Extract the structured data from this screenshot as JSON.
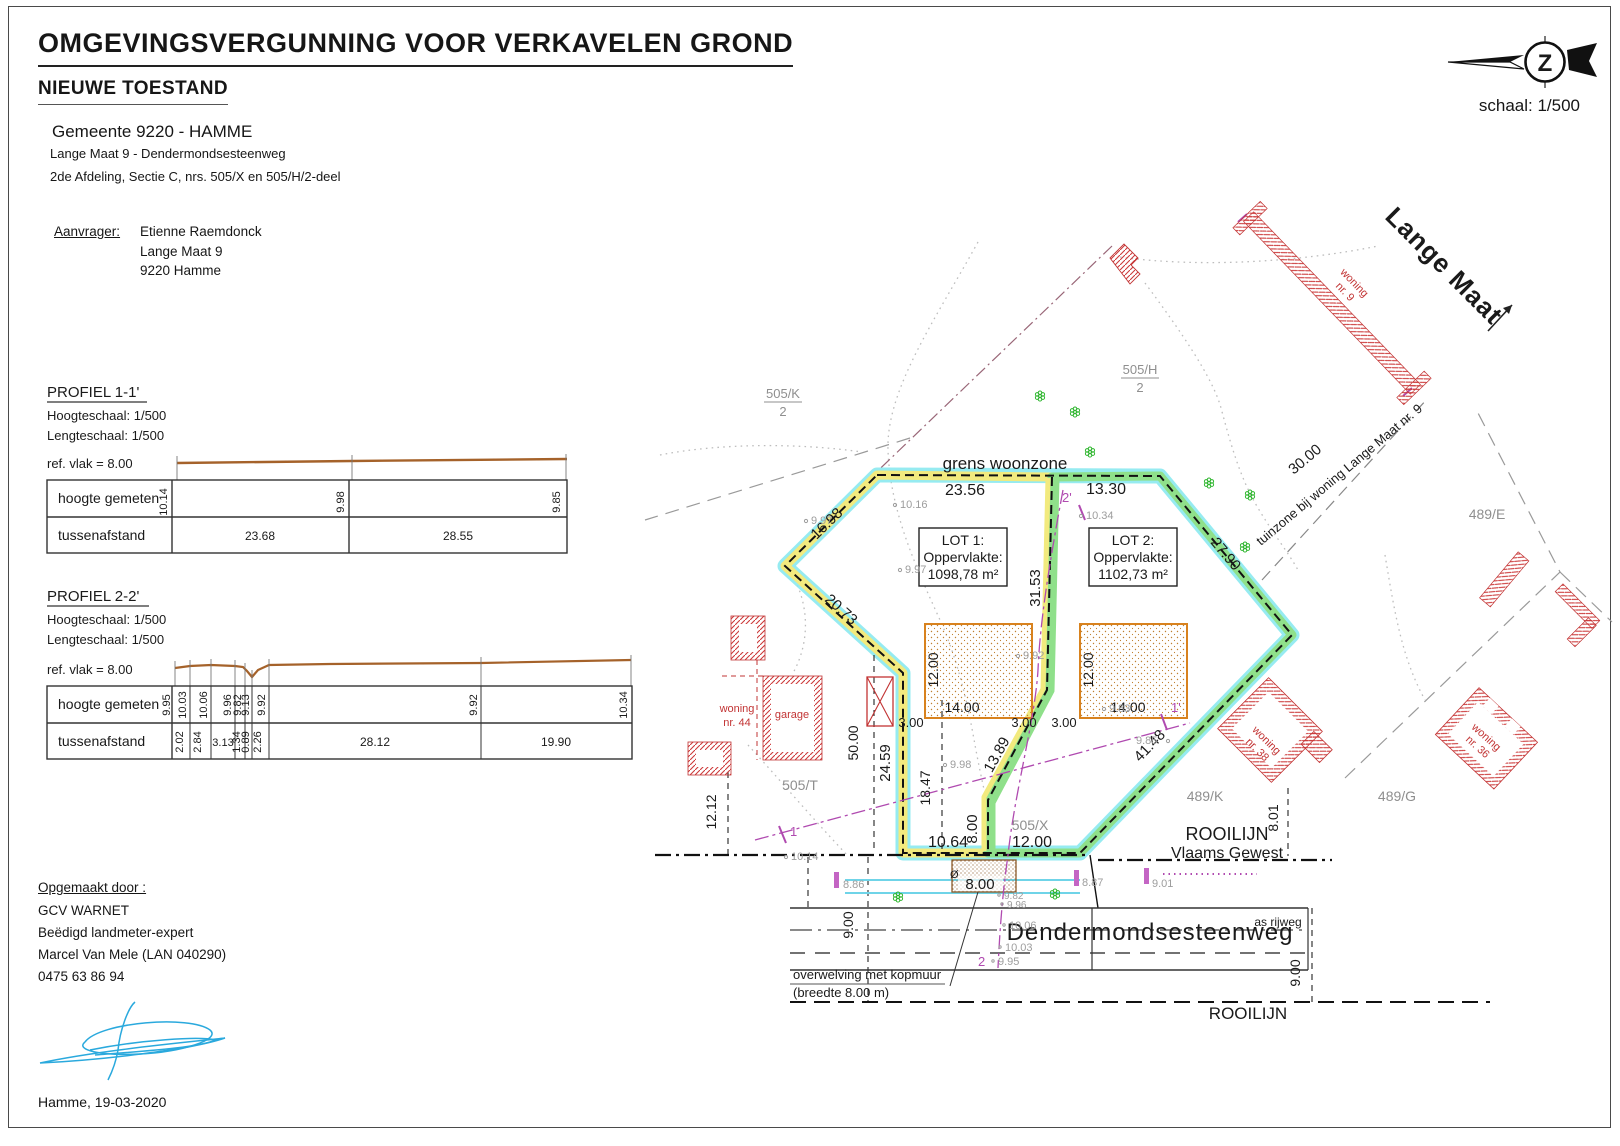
{
  "page": {
    "title": "OMGEVINGSVERGUNNING VOOR VERKAVELEN GROND",
    "subtitle": "NIEUWE TOESTAND",
    "municipality": "Gemeente 9220 - HAMME",
    "address_line1": "Lange Maat 9 - Dendermondsesteenweg",
    "address_line2": "2de Afdeling, Sectie C, nrs. 505/X en 505/H/2-deel",
    "scale_label": "schaal: 1/500",
    "north_letter": "Z",
    "date_line": "Hamme, 19-03-2020"
  },
  "applicant": {
    "label": "Aanvrager:",
    "name": "Etienne Raemdonck",
    "street": "Lange Maat 9",
    "city": "9220 Hamme"
  },
  "author": {
    "label": "Opgemaakt door :",
    "company": "GCV WARNET",
    "role": "Beëdigd landmeter-expert",
    "name": "Marcel Van Mele (LAN 040290)",
    "phone": "0475 63 86 94"
  },
  "profile1": {
    "title": "PROFIEL 1-1'",
    "height_scale": "Hoogteschaal: 1/500",
    "length_scale": "Lengteschaal: 1/500",
    "ref_plane": "ref. vlak = 8.00",
    "row_heights": "hoogte gemeten",
    "row_distances": "tussenafstand",
    "heights": [
      "10.14",
      "9.98",
      "9.85"
    ],
    "distances": [
      "23.68",
      "28.55"
    ]
  },
  "profile2": {
    "title": "PROFIEL 2-2'",
    "height_scale": "Hoogteschaal: 1/500",
    "length_scale": "Lengteschaal: 1/500",
    "ref_plane": "ref. vlak = 8.00",
    "row_heights": "hoogte gemeten",
    "row_distances": "tussenafstand",
    "heights": [
      "9.95",
      "10.03",
      "10.06",
      "9.96",
      "9.82",
      "9.13",
      "9.92",
      "9.92",
      "10.34"
    ],
    "distances": [
      "2.02",
      "2.84",
      "3.13",
      "1.34",
      "0.89",
      "2.26",
      "28.12",
      "19.90"
    ]
  },
  "plan": {
    "zone_label": "grens woonzone",
    "lot1": {
      "name": "LOT 1:",
      "area_label": "Oppervlakte:",
      "area": "1098,78 m²"
    },
    "lot2": {
      "name": "LOT 2:",
      "area_label": "Oppervlakte:",
      "area": "1102,73 m²"
    },
    "streets": {
      "main": "Dendermondsesteenweg",
      "side": "Lange Maat",
      "axis": "as rijweg"
    },
    "rooilijn": {
      "bottom": "ROOILIJN",
      "right1": "ROOILIJN",
      "right2": "Vlaams Gewest"
    },
    "notes": {
      "tuinzone": "tuinzone bij woning Lange Maat nr. 9",
      "culvert1": "overwelving met kopmuur",
      "culvert2": "(breedte 8.00 m)",
      "diameter": "Ø"
    },
    "parcels": {
      "p505k": "505/K",
      "p505k2": "2",
      "p505h": "505/H",
      "p505h2": "2",
      "p505t": "505/T",
      "p505x": "505/X",
      "p489k": "489/K",
      "p489g": "489/G",
      "p489e": "489/E"
    },
    "buildings": {
      "w44_1": "woning",
      "w44_2": "nr. 44",
      "garage": "garage",
      "w9_1": "woning",
      "w9_2": "nr. 9",
      "w38_1": "woning",
      "w38_2": "nr. 38",
      "w36_1": "woning",
      "w36_2": "nr. 36"
    },
    "dims": {
      "top1": "23.56",
      "top2": "13.30",
      "ne": "27.90",
      "se": "41.48",
      "nw1": "16.98",
      "nw2": "20.73",
      "west": "24.59",
      "div1": "31.53",
      "div2": "13.89",
      "div3": "8.00",
      "south1": "10.64",
      "south2": "12.00",
      "ext50": "50.00",
      "ext1847": "18.47",
      "ext1212": "12.12",
      "ext801": "8.01",
      "road9l": "9.00",
      "road9r": "9.00",
      "tuin30": "30.00",
      "culvert8": "8.00",
      "setb1": "3.00",
      "setb2": "3.00",
      "setb3": "3.00",
      "z1w": "14.00",
      "z1h": "12.00",
      "z2w": "14.00",
      "z2h": "12.00"
    },
    "markers": {
      "m1": "1",
      "m1e": "1'",
      "m2": "2",
      "m2e": "2'"
    },
    "elevations": [
      "10.16",
      "9.97",
      "9.97",
      "10.34",
      "9.92",
      "9.83",
      "9.98",
      "9.85",
      "10.14",
      "8.86",
      "8.87",
      "9.01",
      "9.82",
      "9.96",
      "10.06",
      "10.03",
      "9.95"
    ]
  },
  "colors": {
    "band_outer": "#8be9f0",
    "band_lot1": "#f2ea7e",
    "band_lot2": "#8fe08a",
    "zone_stroke": "#d8821e",
    "building_red": "#c23434",
    "profile_line": "#a5622a",
    "signature_blue": "#2aa9dd",
    "magenta": "#b04ab0"
  }
}
